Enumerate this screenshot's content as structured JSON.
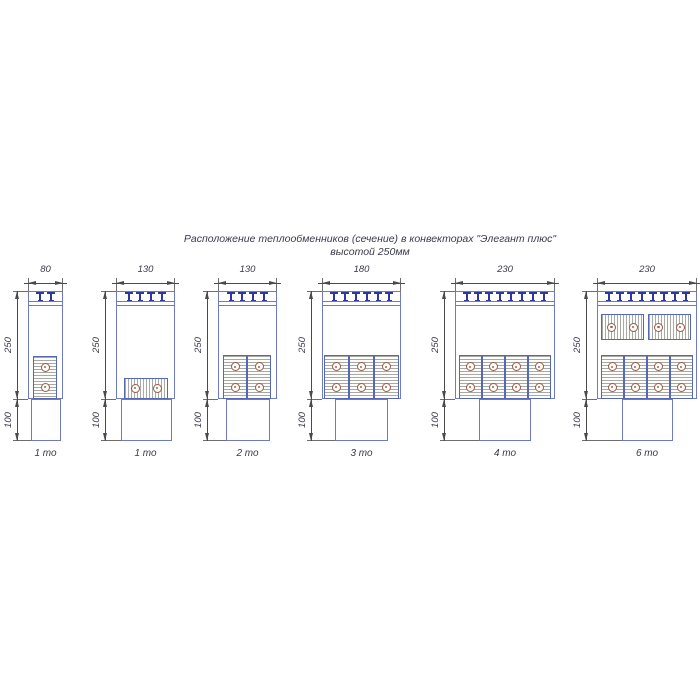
{
  "title": {
    "line1": "Расположение теплообменников (сечение) в конвекторах \"Элегант плюс\"",
    "line2": "высотой 250мм"
  },
  "dim_labels": {
    "height_main": "250",
    "height_base": "100"
  },
  "colors": {
    "outline": "#6e7bc4",
    "grille_mark": "#2c37a0",
    "block_border": "#5767b8",
    "hatch": "#a7a9a4",
    "tube": "#9d5a49",
    "dimension": "#4a4a4a",
    "text": "#3a3a4a"
  },
  "diagrams": [
    {
      "name": "convector-80-1to",
      "width_label": "80",
      "count_label": "1 то",
      "exchanger_count": 1,
      "tmarks": 2,
      "body": {
        "x": 28,
        "w": 35
      },
      "pedestal": {
        "x": 31,
        "w": 30
      },
      "blocks": [
        {
          "orient": "v",
          "x": 33,
          "y": 356,
          "w": 24,
          "h": 43
        }
      ]
    },
    {
      "name": "convector-130-1to",
      "width_label": "130",
      "count_label": "1 то",
      "exchanger_count": 1,
      "tmarks": 4,
      "body": {
        "x": 116,
        "w": 59
      },
      "pedestal": {
        "x": 121,
        "w": 51
      },
      "blocks": [
        {
          "orient": "h",
          "x": 124,
          "y": 378,
          "w": 44,
          "h": 21
        }
      ]
    },
    {
      "name": "convector-130-2to",
      "width_label": "130",
      "count_label": "2 то",
      "exchanger_count": 2,
      "tmarks": 4,
      "body": {
        "x": 218,
        "w": 59
      },
      "pedestal": {
        "x": 226,
        "w": 44
      },
      "blocks": [
        {
          "orient": "v",
          "x": 223,
          "y": 355,
          "w": 24,
          "h": 44
        },
        {
          "orient": "v",
          "x": 247,
          "y": 355,
          "w": 24,
          "h": 44
        }
      ]
    },
    {
      "name": "convector-180-3to",
      "width_label": "180",
      "count_label": "3 то",
      "exchanger_count": 3,
      "tmarks": 6,
      "body": {
        "x": 322,
        "w": 79
      },
      "pedestal": {
        "x": 335,
        "w": 53
      },
      "blocks": [
        {
          "orient": "v",
          "x": 324,
          "y": 355,
          "w": 25,
          "h": 44
        },
        {
          "orient": "v",
          "x": 349,
          "y": 355,
          "w": 25,
          "h": 44
        },
        {
          "orient": "v",
          "x": 374,
          "y": 355,
          "w": 25,
          "h": 44
        }
      ]
    },
    {
      "name": "convector-230-4to",
      "width_label": "230",
      "count_label": "4 то",
      "exchanger_count": 4,
      "tmarks": 8,
      "body": {
        "x": 455,
        "w": 100
      },
      "pedestal": {
        "x": 479,
        "w": 52
      },
      "blocks": [
        {
          "orient": "v",
          "x": 459,
          "y": 355,
          "w": 23,
          "h": 44
        },
        {
          "orient": "v",
          "x": 482,
          "y": 355,
          "w": 23,
          "h": 44
        },
        {
          "orient": "v",
          "x": 505,
          "y": 355,
          "w": 23,
          "h": 44
        },
        {
          "orient": "v",
          "x": 528,
          "y": 355,
          "w": 23,
          "h": 44
        }
      ]
    },
    {
      "name": "convector-230-6to",
      "width_label": "230",
      "count_label": "6 то",
      "exchanger_count": 6,
      "tmarks": 8,
      "body": {
        "x": 597,
        "w": 100
      },
      "pedestal": {
        "x": 622,
        "w": 51
      },
      "blocks": [
        {
          "orient": "h",
          "x": 601,
          "y": 314,
          "w": 43,
          "h": 26
        },
        {
          "orient": "h",
          "x": 648,
          "y": 314,
          "w": 43,
          "h": 26
        },
        {
          "orient": "v",
          "x": 601,
          "y": 355,
          "w": 23,
          "h": 44
        },
        {
          "orient": "v",
          "x": 624,
          "y": 355,
          "w": 23,
          "h": 44
        },
        {
          "orient": "v",
          "x": 647,
          "y": 355,
          "w": 23,
          "h": 44
        },
        {
          "orient": "v",
          "x": 670,
          "y": 355,
          "w": 23,
          "h": 44
        }
      ]
    }
  ]
}
